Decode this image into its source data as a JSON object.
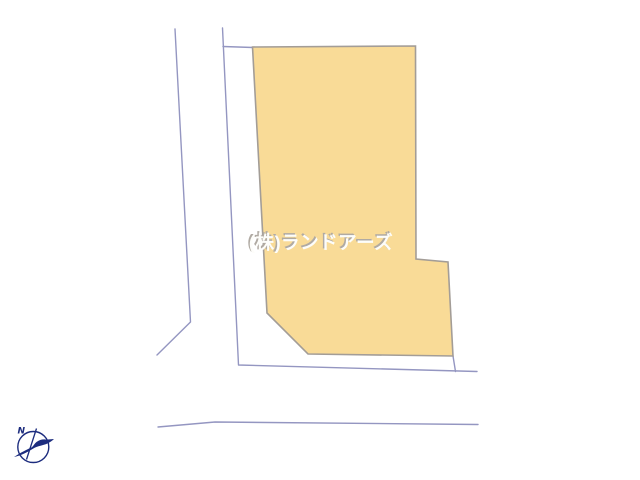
{
  "canvas": {
    "width": 640,
    "height": 480,
    "background": "#ffffff"
  },
  "watermark": {
    "text": "(株)ランドアーズ",
    "color": "#fdfdfa",
    "shadow_color": "#b0aaa3"
  },
  "compass": {
    "label": "N",
    "color": "#1c2c7e"
  },
  "drawing": {
    "lot_parcel": {
      "fill": "#f9db97",
      "stroke": "#a39d97",
      "stroke_width": 1.6,
      "points": [
        [
          252.5,
          47
        ],
        [
          415.5,
          46
        ],
        [
          416,
          259
        ],
        [
          448,
          262
        ],
        [
          453,
          356
        ],
        [
          308,
          354
        ],
        [
          267,
          313
        ]
      ]
    },
    "road_lines": {
      "stroke": "#9496c1",
      "stroke_width": 1.4,
      "polylines": [
        [
          [
            175,
            29
          ],
          [
            190.5,
            322
          ],
          [
            157,
            355
          ]
        ],
        [
          [
            222.5,
            28
          ],
          [
            238.5,
            365
          ],
          [
            477,
            371.5
          ]
        ],
        [
          [
            223,
            46.5
          ],
          [
            253,
            47.5
          ]
        ],
        [
          [
            453,
            356
          ],
          [
            455.5,
            371.5
          ]
        ],
        [
          [
            158,
            427
          ],
          [
            215,
            422
          ],
          [
            478,
            424.5
          ]
        ]
      ]
    }
  }
}
